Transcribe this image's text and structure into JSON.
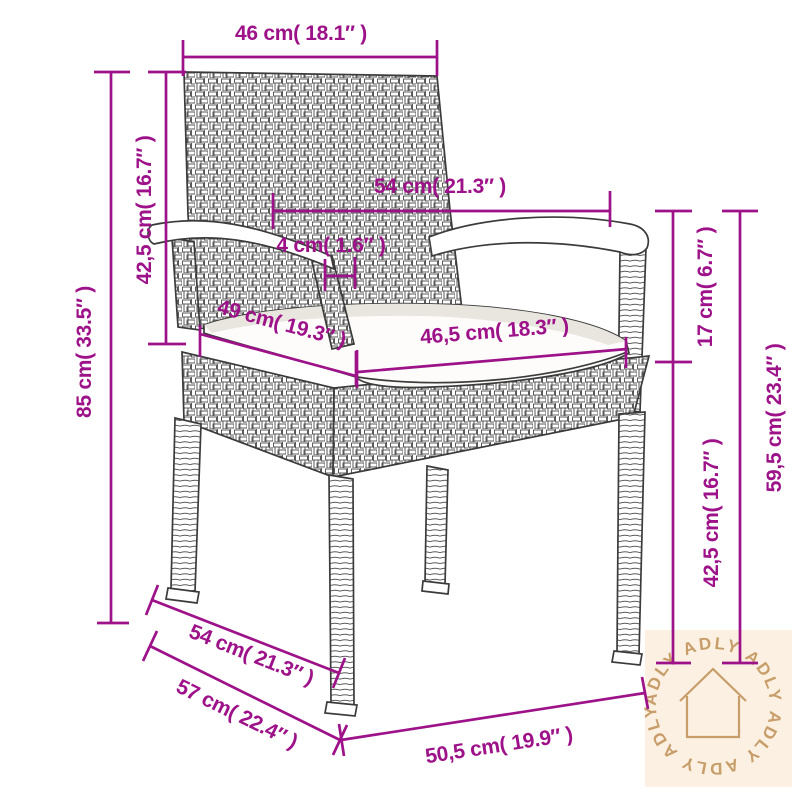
{
  "image_type": "product-dimension-diagram",
  "product": "wicker armchair with seat cushion",
  "colors": {
    "dimension": "#9D1189",
    "chair_line": "#3b3b3b",
    "watermark_bg": "#fbf0e2",
    "watermark_fg": "#c79d69",
    "background": "#ffffff"
  },
  "units": {
    "primary": "cm",
    "secondary": "inches"
  },
  "measurements": {
    "back_width": {
      "label": "46 cm( 18.1″ )",
      "cm": "46",
      "in": "18.1"
    },
    "back_height": {
      "label": "42,5 cm( 16.7″ )",
      "cm": "42,5",
      "in": "16.7"
    },
    "total_height": {
      "label": "85 cm( 33.5″ )",
      "cm": "85",
      "in": "33.5"
    },
    "armrest_span": {
      "label": "54 cm( 21.3″ )",
      "cm": "54",
      "in": "21.3"
    },
    "armrest_width": {
      "label": "4 cm( 1.6″ )",
      "cm": "4",
      "in": "1.6"
    },
    "seat_depth": {
      "label": "49 cm( 19.3″ )",
      "cm": "49",
      "in": "19.3"
    },
    "seat_width": {
      "label": "46,5 cm( 18.3″ )",
      "cm": "46,5",
      "in": "18.3"
    },
    "armrest_to_seat": {
      "label": "17 cm( 6.7″ )",
      "cm": "17",
      "in": "6.7"
    },
    "armrest_height": {
      "label": "59,5 cm( 23.4″ )",
      "cm": "59,5",
      "in": "23.4"
    },
    "seat_height": {
      "label": "42,5 cm( 16.7″ )",
      "cm": "42,5",
      "in": "16.7"
    },
    "base_depth": {
      "label": "54 cm( 21.3″ )",
      "cm": "54",
      "in": "21.3"
    },
    "total_depth": {
      "label": "57 cm( 22.4″ )",
      "cm": "57",
      "in": "22.4"
    },
    "base_width": {
      "label": "50,5 cm( 19.9″ )",
      "cm": "50,5",
      "in": "19.9"
    }
  },
  "watermark": {
    "brand": "ADLY",
    "ring_text": "ADLY  ADLY  ADLY  ADLY  ADLY  ADLY",
    "icon": "house-icon"
  }
}
